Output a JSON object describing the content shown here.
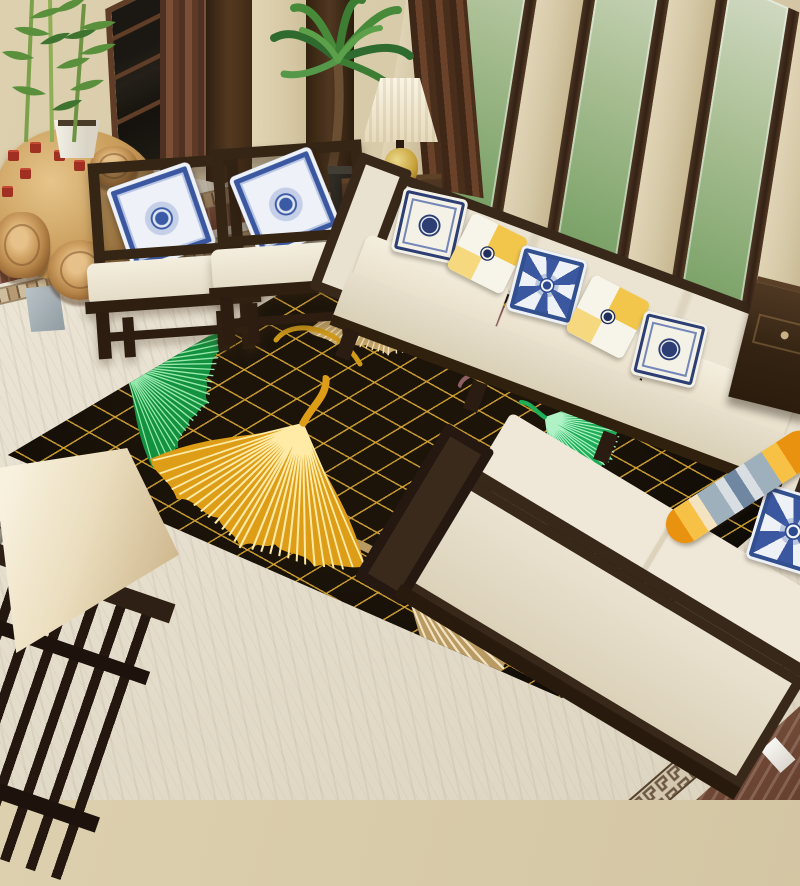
{
  "meta": {
    "type": "product-photograph",
    "description": "New Chinese style living room with a black and gold ginkgo-leaf area rug, cream wood-framed sofas, porcelain pillows and garden windows",
    "canvas": {
      "width": 800,
      "height": 800
    }
  },
  "palette": {
    "wall_beige": "#d8cbaa",
    "wood_dark_espresso": "#352515",
    "window_frame_brown": "#402d1d",
    "curtain_brown": "#6b4430",
    "glass_foliage_green": "#6f9a5e",
    "marble_floor": "#e8e1d1",
    "mosaic_tan": "#b59a73",
    "greek_key_brown": "#6d5844",
    "gray_stripe": "#8b867b",
    "brown_marble_band": "#7d4b36",
    "rug_black": "#0b0906",
    "rug_gold_lattice": "#d4a432",
    "leaf_pale_gold": "#c9a96b",
    "leaf_amber_gold": "#dd9d16",
    "leaf_green": "#1aa14f",
    "leaf_mauve": "#8f5f63",
    "leaf_champagne": "#b99a62",
    "sofa_cream": "#ece4d2",
    "pillow_navy": "#2c3e74",
    "pillow_yellow": "#f2c64b",
    "porcelain_blue": "#3a57a0",
    "lamp_shade_cream": "#f6efdc",
    "lamp_base_gold": "#c8a23c",
    "plant_green": "#478b3a",
    "stump_wood": "#b07f44"
  },
  "scene": {
    "rug": {
      "style": "black quilted diamond lattice with gold stitching and oversized ginkgo leaves",
      "leaves": [
        {
          "id": "pale-gold-top",
          "color": "pale gold"
        },
        {
          "id": "green-left",
          "color": "emerald green"
        },
        {
          "id": "amber-center",
          "color": "amber gold",
          "detail": "long curved stem"
        },
        {
          "id": "mauve-right",
          "color": "rosewood mauve"
        },
        {
          "id": "green-right",
          "color": "emerald green"
        },
        {
          "id": "champagne-bottom",
          "color": "champagne tan"
        }
      ]
    },
    "furniture": {
      "armchairs": {
        "count": 2,
        "style": "dark wood open-frame chairs with cream cushions and blue porcelain pillows"
      },
      "long_sofa": {
        "pillows": [
          "white-navy medallion",
          "yellow color-block",
          "blue porcelain",
          "yellow color-block",
          "white-navy medallion"
        ]
      },
      "right_sofa": {
        "items": [
          "blue porcelain pillow",
          "striped plush toy"
        ]
      },
      "side_tables": {
        "count": 2,
        "style": "dark wood chests with drawers"
      },
      "tea_table": {
        "style": "carved root wood",
        "items": "red tea cups"
      },
      "stools": {
        "count": 4,
        "style": "tree stump"
      },
      "railing": "dark wood slatted railing (foreground)",
      "floor_lamp_shade": "cream fabric shade (foreground corner)"
    },
    "decor": {
      "table_lamp": "cream pleated shade on gold ceramic jar base",
      "plants": [
        "bamboo in white planter",
        "potted palm"
      ],
      "windows": "floor-to-ceiling dark wood framed windows with garden view",
      "curtains": "brown drapes"
    },
    "floor": {
      "material": "cream travertine marble",
      "borders": [
        "tan mosaic strips",
        "brown marble band",
        "gray stone stripe",
        "greek key meander strips",
        "brown marble corner"
      ]
    }
  }
}
